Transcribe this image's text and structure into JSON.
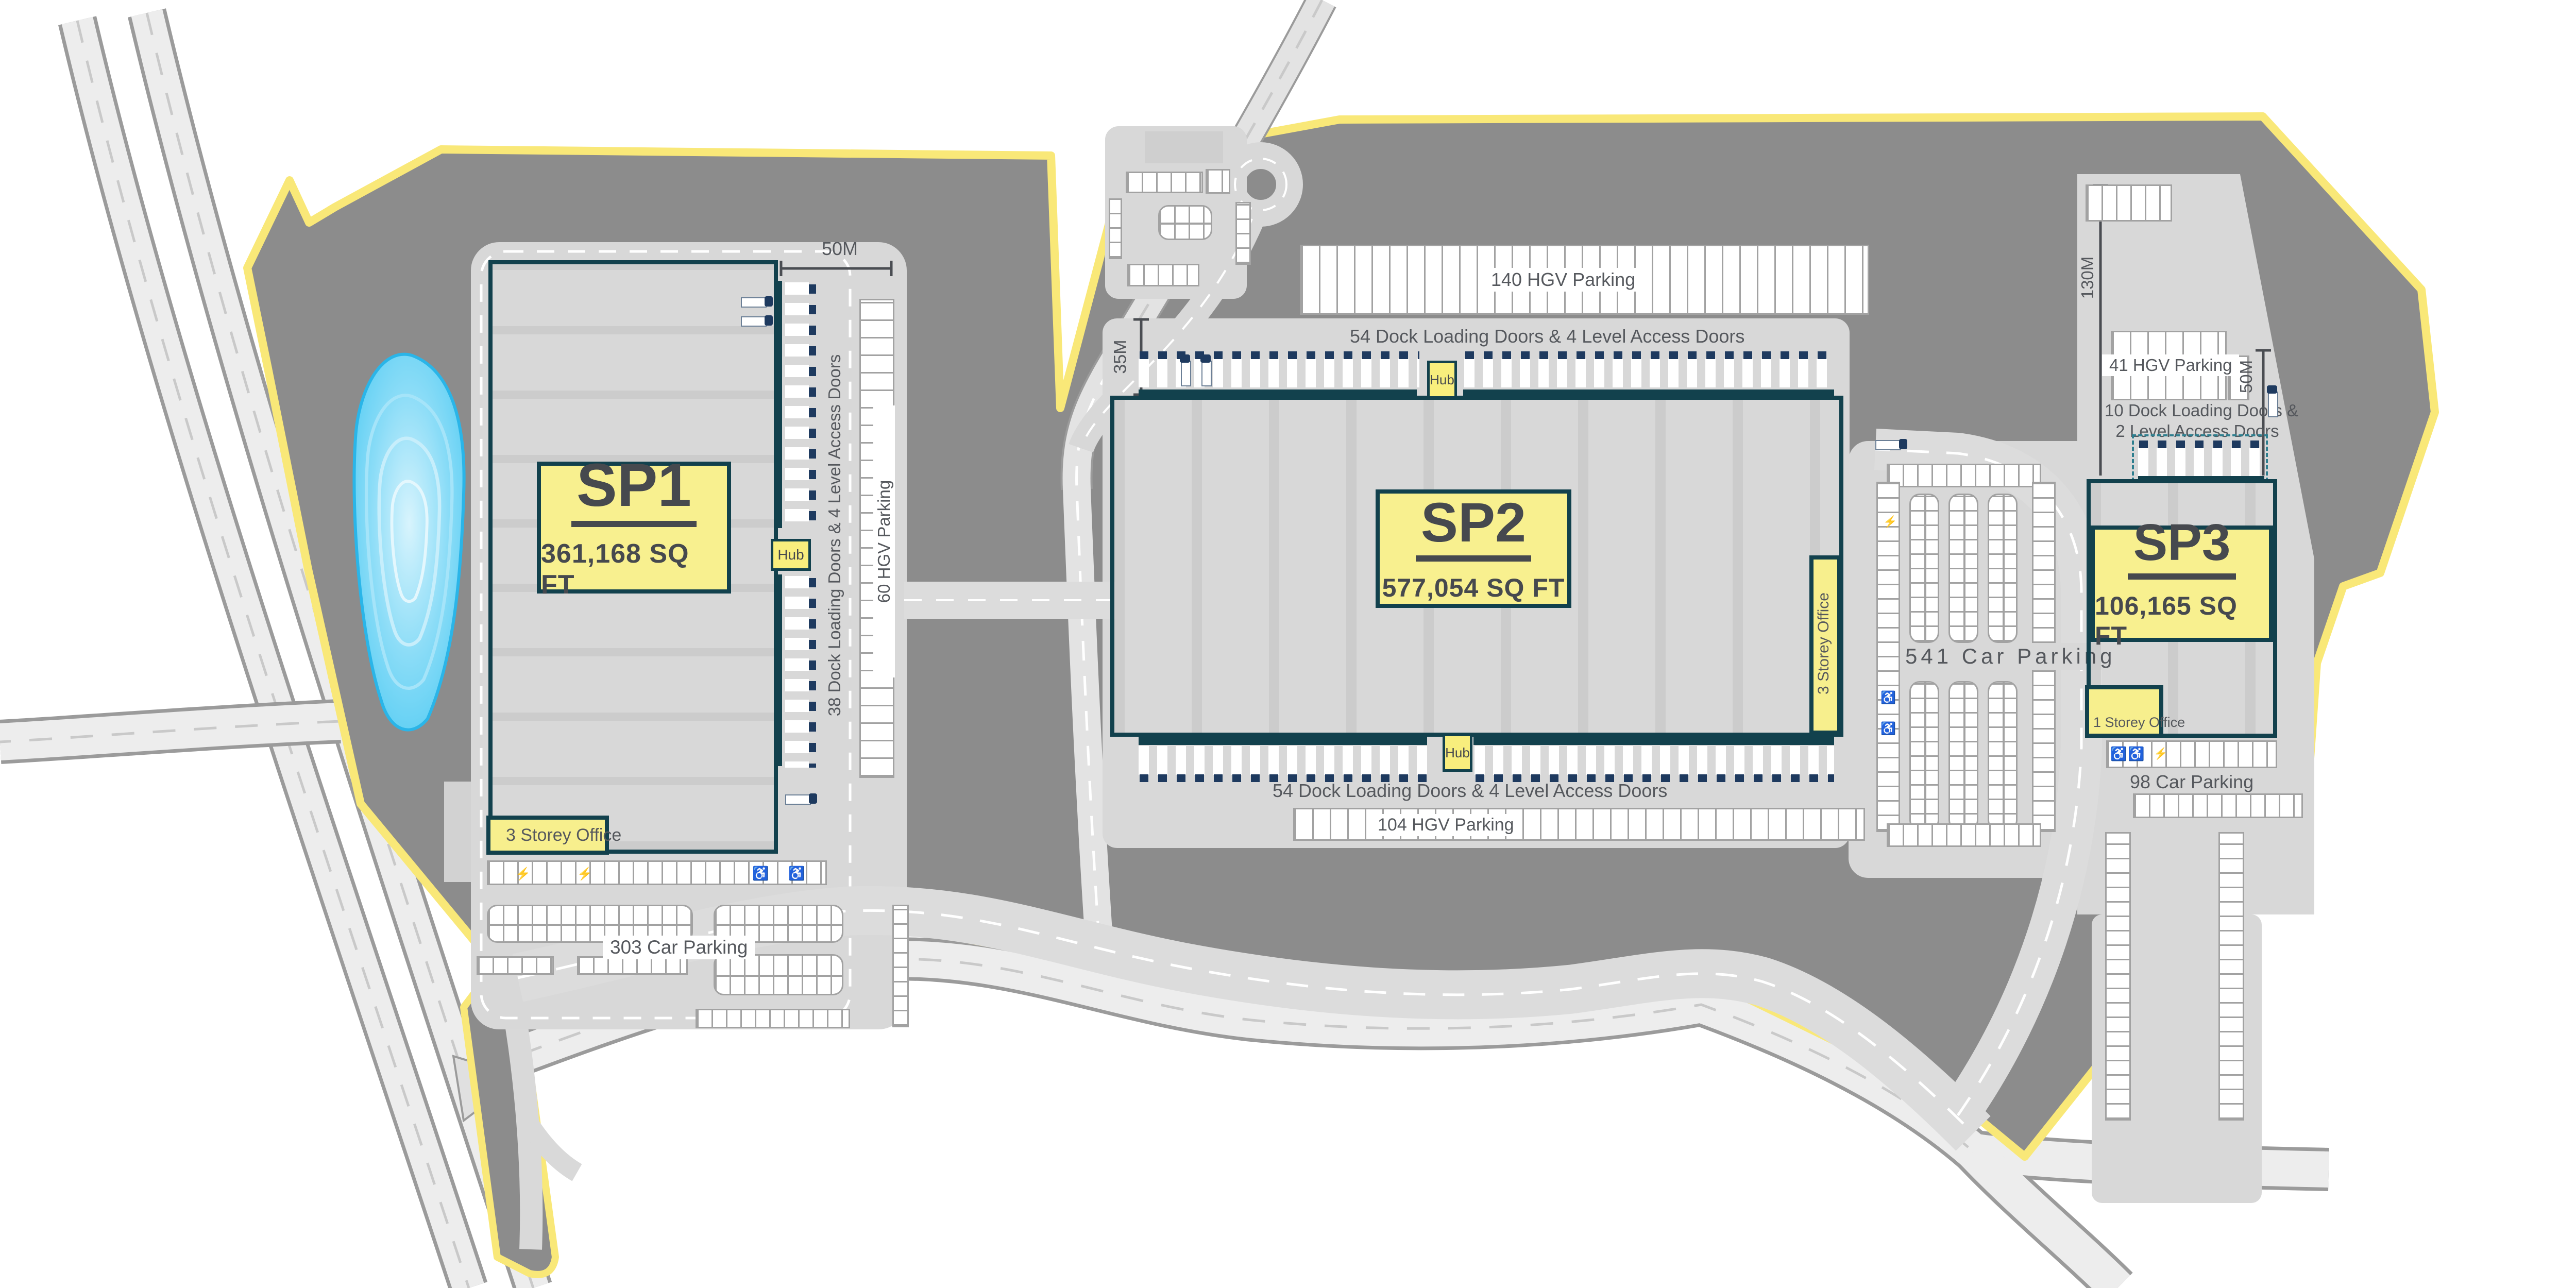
{
  "buildings": {
    "sp1": {
      "name": "SP1",
      "area": "361,168 SQ FT",
      "office_label": "3 Storey Office",
      "dock_label": "38 Dock Loading Doors & 4 Level Access Doors",
      "hgv_label": "60 HGV Parking",
      "car_label": "303 Car Parking",
      "hub_label": "Hub",
      "dim_width": "50M"
    },
    "sp2": {
      "name": "SP2",
      "area": "577,054 SQ FT",
      "hgv_top_label": "140 HGV Parking",
      "dock_top_label": "54 Dock Loading Doors & 4 Level Access Doors",
      "dock_bottom_label": "54 Dock Loading Doors & 4 Level Access Doors",
      "hgv_bottom_label": "104 HGV Parking",
      "office_label": "3 Storey Office",
      "hub_top_label": "Hub",
      "hub_bottom_label": "Hub",
      "dim_depth": "35M"
    },
    "sp3": {
      "name": "SP3",
      "area": "106,165 SQ FT",
      "hgv_label": "41 HGV Parking",
      "dock_line1": "10 Dock Loading Doors &",
      "dock_line2": "2 Level Access Doors",
      "office_label": "1 Storey Office",
      "car_label": "98 Car Parking",
      "dim_height": "130M",
      "dim_width": "50M"
    }
  },
  "site": {
    "car_541_label": "541 Car Parking"
  },
  "icons": {
    "disabled": "♿",
    "ev": "⚡"
  },
  "colors": {
    "site_grey": "#8c8c8c",
    "apron_grey": "#d8d8d8",
    "boundary_yellow": "#f9e878",
    "building_yellow": "#f7ef8d",
    "building_border_teal": "#12414d",
    "truck_navy": "#1e3a5f",
    "pond_blue": "#54ccf3",
    "text_grey": "#55585d"
  }
}
